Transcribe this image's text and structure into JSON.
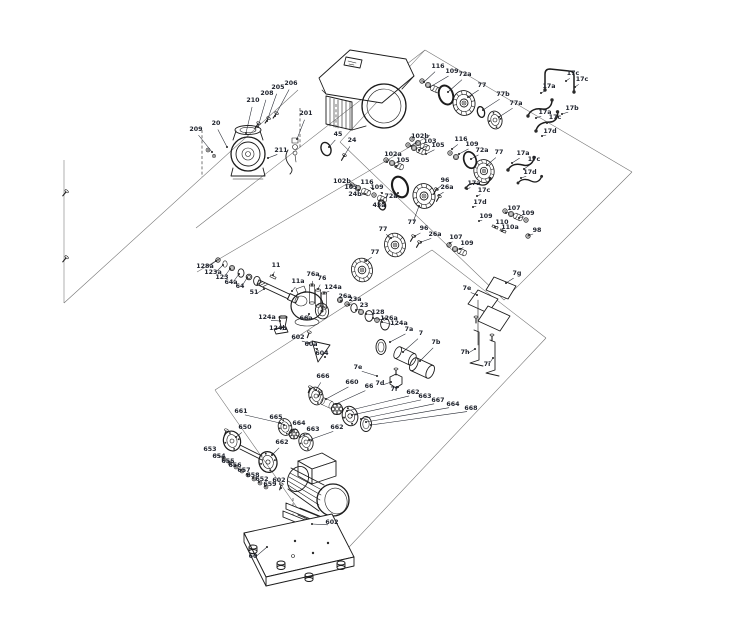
{
  "diagram": {
    "type": "exploded-parts-diagram",
    "subject": "multistage centrifugal pump with drive unit, shaft seal kits, couplings, motor and base plate",
    "colors": {
      "background": "#ffffff",
      "line": "#1c1c1c",
      "guide_line": "#6e6e6e",
      "label_text": "#20242e"
    },
    "icons": [
      {
        "name": "pump-head",
        "shape": "concentric-circles-with-flange"
      },
      {
        "name": "drive-unit",
        "shape": "rounded-box-with-vents"
      },
      {
        "name": "o-ring",
        "shape": "tilted-ellipse"
      },
      {
        "name": "seal-disc",
        "shape": "ribbed-disc"
      },
      {
        "name": "coupling-star",
        "shape": "lobed-circle"
      },
      {
        "name": "motor",
        "shape": "finned-cylinder"
      },
      {
        "name": "base-plate",
        "shape": "parallelogram-with-feet"
      }
    ],
    "parts": [
      {
        "l": "209",
        "x": 196,
        "y": 131,
        "tx": 212,
        "ty": 152
      },
      {
        "l": "20",
        "x": 216,
        "y": 125,
        "tx": 227,
        "ty": 147
      },
      {
        "l": "210",
        "x": 253,
        "y": 102,
        "tx": 246,
        "ty": 133
      },
      {
        "l": "208",
        "x": 267,
        "y": 95,
        "tx": 258,
        "ty": 127
      },
      {
        "l": "205",
        "x": 278,
        "y": 89,
        "tx": 267,
        "ty": 121
      },
      {
        "l": "206",
        "x": 291,
        "y": 85,
        "tx": 275,
        "ty": 116
      },
      {
        "l": "201",
        "x": 306,
        "y": 115,
        "tx": 297,
        "ty": 139
      },
      {
        "l": "211",
        "x": 281,
        "y": 152,
        "tx": 268,
        "ty": 158
      },
      {
        "l": "45",
        "x": 338,
        "y": 136,
        "tx": 329,
        "ty": 147
      },
      {
        "l": "24",
        "x": 352,
        "y": 142,
        "tx": 344,
        "ty": 156
      },
      {
        "l": "116",
        "x": 438,
        "y": 68,
        "tx": 424,
        "ty": 82
      },
      {
        "l": "109",
        "x": 452,
        "y": 73,
        "tx": 430,
        "ty": 87
      },
      {
        "l": "72a",
        "x": 465,
        "y": 76,
        "tx": 448,
        "ty": 92
      },
      {
        "l": "77",
        "x": 482,
        "y": 87,
        "tx": 468,
        "ty": 97
      },
      {
        "l": "77b",
        "x": 503,
        "y": 96,
        "tx": 483,
        "ty": 110
      },
      {
        "l": "77a",
        "x": 516,
        "y": 105,
        "tx": 499,
        "ty": 117
      },
      {
        "l": "17a",
        "x": 549,
        "y": 88,
        "tx": 541,
        "ty": 93
      },
      {
        "l": "17c",
        "x": 573,
        "y": 75,
        "tx": 566,
        "ty": 81
      },
      {
        "l": "17c",
        "x": 582,
        "y": 81,
        "tx": 575,
        "ty": 87
      },
      {
        "l": "17b",
        "x": 572,
        "y": 110,
        "tx": 562,
        "ty": 114
      },
      {
        "l": "17a",
        "x": 545,
        "y": 114,
        "tx": 536,
        "ty": 118
      },
      {
        "l": "17c",
        "x": 555,
        "y": 119,
        "tx": 547,
        "ty": 123
      },
      {
        "l": "17d",
        "x": 550,
        "y": 133,
        "tx": 542,
        "ty": 136
      },
      {
        "l": "102b",
        "x": 420,
        "y": 138,
        "tx": 411,
        "ty": 146
      },
      {
        "l": "103",
        "x": 430,
        "y": 143,
        "tx": 419,
        "ty": 150
      },
      {
        "l": "105",
        "x": 438,
        "y": 147,
        "tx": 426,
        "ty": 154
      },
      {
        "l": "116",
        "x": 461,
        "y": 141,
        "tx": 452,
        "ty": 149
      },
      {
        "l": "109",
        "x": 472,
        "y": 146,
        "tx": 459,
        "ty": 154
      },
      {
        "l": "72a",
        "x": 482,
        "y": 152,
        "tx": 471,
        "ty": 159
      },
      {
        "l": "77",
        "x": 499,
        "y": 154,
        "tx": 487,
        "ty": 165
      },
      {
        "l": "17a",
        "x": 523,
        "y": 155,
        "tx": 512,
        "ty": 163
      },
      {
        "l": "17c",
        "x": 534,
        "y": 161,
        "tx": 524,
        "ty": 169
      },
      {
        "l": "17d",
        "x": 530,
        "y": 174,
        "tx": 521,
        "ty": 178
      },
      {
        "l": "102a",
        "x": 393,
        "y": 156,
        "tx": 387,
        "ty": 162
      },
      {
        "l": "105",
        "x": 403,
        "y": 162,
        "tx": 396,
        "ty": 166
      },
      {
        "l": "102b",
        "x": 342,
        "y": 183,
        "tx": 351,
        "ty": 185
      },
      {
        "l": "103",
        "x": 351,
        "y": 189,
        "tx": 359,
        "ty": 190
      },
      {
        "l": "24b",
        "x": 355,
        "y": 196,
        "tx": 365,
        "ty": 194
      },
      {
        "l": "116",
        "x": 367,
        "y": 184,
        "tx": 373,
        "ty": 189
      },
      {
        "l": "109",
        "x": 377,
        "y": 189,
        "tx": 382,
        "ty": 193
      },
      {
        "l": "72a",
        "x": 391,
        "y": 198,
        "tx": 398,
        "ty": 193
      },
      {
        "l": "43a",
        "x": 379,
        "y": 207,
        "tx": 383,
        "ty": 203
      },
      {
        "l": "77",
        "x": 412,
        "y": 224,
        "tx": 419,
        "ty": 206
      },
      {
        "l": "96",
        "x": 445,
        "y": 182,
        "tx": 437,
        "ty": 189
      },
      {
        "l": "26a",
        "x": 447,
        "y": 189,
        "tx": 439,
        "ty": 195
      },
      {
        "l": "17a",
        "x": 474,
        "y": 185,
        "tx": 467,
        "ty": 189
      },
      {
        "l": "17c",
        "x": 484,
        "y": 192,
        "tx": 477,
        "ty": 196
      },
      {
        "l": "17d",
        "x": 480,
        "y": 204,
        "tx": 473,
        "ty": 207
      },
      {
        "l": "107",
        "x": 514,
        "y": 210,
        "tx": 506,
        "ty": 213
      },
      {
        "l": "109",
        "x": 528,
        "y": 215,
        "tx": 519,
        "ty": 218
      },
      {
        "l": "109",
        "x": 486,
        "y": 218,
        "tx": 479,
        "ty": 221
      },
      {
        "l": "110",
        "x": 502,
        "y": 224,
        "tx": 495,
        "ty": 227
      },
      {
        "l": "110a",
        "x": 510,
        "y": 229,
        "tx": 502,
        "ty": 231
      },
      {
        "l": "98",
        "x": 537,
        "y": 232,
        "tx": 529,
        "ty": 235
      },
      {
        "l": "107",
        "x": 456,
        "y": 239,
        "tx": 450,
        "ty": 243
      },
      {
        "l": "109",
        "x": 467,
        "y": 245,
        "tx": 460,
        "ty": 249
      },
      {
        "l": "96",
        "x": 424,
        "y": 230,
        "tx": 415,
        "ty": 236
      },
      {
        "l": "26a",
        "x": 435,
        "y": 236,
        "tx": 421,
        "ty": 242
      },
      {
        "l": "77",
        "x": 383,
        "y": 231,
        "tx": 391,
        "ty": 238
      },
      {
        "l": "77",
        "x": 375,
        "y": 254,
        "tx": 366,
        "ty": 261
      },
      {
        "l": "128a",
        "x": 205,
        "y": 268,
        "tx": 216,
        "ty": 261
      },
      {
        "l": "123a",
        "x": 213,
        "y": 274,
        "tx": 223,
        "ty": 265
      },
      {
        "l": "123",
        "x": 222,
        "y": 279,
        "tx": 230,
        "ty": 269
      },
      {
        "l": "64a",
        "x": 231,
        "y": 284,
        "tx": 239,
        "ty": 274
      },
      {
        "l": "64",
        "x": 240,
        "y": 288,
        "tx": 247,
        "ty": 278
      },
      {
        "l": "11",
        "x": 276,
        "y": 267,
        "tx": 273,
        "ty": 275
      },
      {
        "l": "51",
        "x": 254,
        "y": 294,
        "tx": 264,
        "ty": 289
      },
      {
        "l": "11a",
        "x": 298,
        "y": 283,
        "tx": 292,
        "ty": 291
      },
      {
        "l": "76a",
        "x": 313,
        "y": 276,
        "tx": 312,
        "ty": 285
      },
      {
        "l": "76",
        "x": 322,
        "y": 280,
        "tx": 318,
        "ty": 289
      },
      {
        "l": "124a",
        "x": 333,
        "y": 289,
        "tx": 324,
        "ty": 293
      },
      {
        "l": "26a",
        "x": 345,
        "y": 298,
        "tx": 341,
        "ty": 301
      },
      {
        "l": "23a",
        "x": 355,
        "y": 301,
        "tx": 349,
        "ty": 305
      },
      {
        "l": "23",
        "x": 364,
        "y": 307,
        "tx": 356,
        "ty": 310
      },
      {
        "l": "128",
        "x": 378,
        "y": 314,
        "tx": 366,
        "ty": 314
      },
      {
        "l": "126a",
        "x": 389,
        "y": 320,
        "tx": 373,
        "ty": 318
      },
      {
        "l": "124a",
        "x": 399,
        "y": 325,
        "tx": 382,
        "ty": 322
      },
      {
        "l": "7a",
        "x": 409,
        "y": 331,
        "tx": 390,
        "ty": 342
      },
      {
        "l": "7",
        "x": 421,
        "y": 335,
        "tx": 403,
        "ty": 352
      },
      {
        "l": "7b",
        "x": 436,
        "y": 344,
        "tx": 420,
        "ty": 361
      },
      {
        "l": "66a",
        "x": 306,
        "y": 320,
        "tx": 309,
        "ty": 314
      },
      {
        "l": "124a",
        "x": 267,
        "y": 319,
        "tx": 280,
        "ty": 321
      },
      {
        "l": "124b",
        "x": 278,
        "y": 330,
        "tx": 286,
        "ty": 329
      },
      {
        "l": "602",
        "x": 298,
        "y": 339,
        "tx": 309,
        "ty": 343
      },
      {
        "l": "60a",
        "x": 311,
        "y": 346,
        "tx": 317,
        "ty": 349
      },
      {
        "l": "604",
        "x": 322,
        "y": 355,
        "tx": 325,
        "ty": 357
      },
      {
        "l": "7e",
        "x": 358,
        "y": 369,
        "tx": 377,
        "ty": 376
      },
      {
        "l": "7d",
        "x": 380,
        "y": 385,
        "tx": 391,
        "ty": 382
      },
      {
        "l": "7f",
        "x": 394,
        "y": 391,
        "tx": 398,
        "ty": 387
      },
      {
        "l": "7g",
        "x": 517,
        "y": 275,
        "tx": 506,
        "ty": 283
      },
      {
        "l": "7e",
        "x": 467,
        "y": 290,
        "tx": 477,
        "ty": 295
      },
      {
        "l": "7h",
        "x": 465,
        "y": 354,
        "tx": 475,
        "ty": 349
      },
      {
        "l": "7i",
        "x": 487,
        "y": 366,
        "tx": 493,
        "ty": 358
      },
      {
        "l": "666",
        "x": 323,
        "y": 378,
        "tx": 316,
        "ty": 390
      },
      {
        "l": "660",
        "x": 352,
        "y": 384,
        "tx": 326,
        "ty": 399
      },
      {
        "l": "66",
        "x": 369,
        "y": 388,
        "tx": 336,
        "ty": 404
      },
      {
        "l": "662",
        "x": 413,
        "y": 394,
        "tx": 347,
        "ty": 411
      },
      {
        "l": "663",
        "x": 425,
        "y": 398,
        "tx": 352,
        "ty": 415
      },
      {
        "l": "667",
        "x": 438,
        "y": 402,
        "tx": 361,
        "ty": 419
      },
      {
        "l": "664",
        "x": 453,
        "y": 406,
        "tx": 366,
        "ty": 422
      },
      {
        "l": "668",
        "x": 471,
        "y": 410,
        "tx": 371,
        "ty": 425
      },
      {
        "l": "661",
        "x": 241,
        "y": 413,
        "tx": 280,
        "ty": 423
      },
      {
        "l": "665",
        "x": 276,
        "y": 419,
        "tx": 284,
        "ty": 425
      },
      {
        "l": "664",
        "x": 299,
        "y": 425,
        "tx": 292,
        "ty": 431
      },
      {
        "l": "663",
        "x": 313,
        "y": 431,
        "tx": 300,
        "ty": 437
      },
      {
        "l": "662",
        "x": 337,
        "y": 429,
        "tx": 309,
        "ty": 440
      },
      {
        "l": "650",
        "x": 245,
        "y": 429,
        "tx": 236,
        "ty": 437
      },
      {
        "l": "653",
        "x": 210,
        "y": 451,
        "tx": 223,
        "ty": 458
      },
      {
        "l": "654",
        "x": 219,
        "y": 458,
        "tx": 229,
        "ty": 462
      },
      {
        "l": "655",
        "x": 228,
        "y": 463,
        "tx": 235,
        "ty": 466
      },
      {
        "l": "656",
        "x": 235,
        "y": 467,
        "tx": 241,
        "ty": 470
      },
      {
        "l": "657",
        "x": 244,
        "y": 472,
        "tx": 247,
        "ty": 474
      },
      {
        "l": "658",
        "x": 253,
        "y": 477,
        "tx": 253,
        "ty": 478
      },
      {
        "l": "652",
        "x": 262,
        "y": 481,
        "tx": 259,
        "ty": 482
      },
      {
        "l": "659",
        "x": 270,
        "y": 486,
        "tx": 265,
        "ty": 486
      },
      {
        "l": "662",
        "x": 282,
        "y": 444,
        "tx": 272,
        "ty": 455
      },
      {
        "l": "602",
        "x": 279,
        "y": 482,
        "tx": 281,
        "ty": 488
      },
      {
        "l": "602",
        "x": 332,
        "y": 524,
        "tx": 312,
        "ty": 524
      },
      {
        "l": "60",
        "x": 253,
        "y": 558,
        "tx": 267,
        "ty": 547
      }
    ]
  }
}
